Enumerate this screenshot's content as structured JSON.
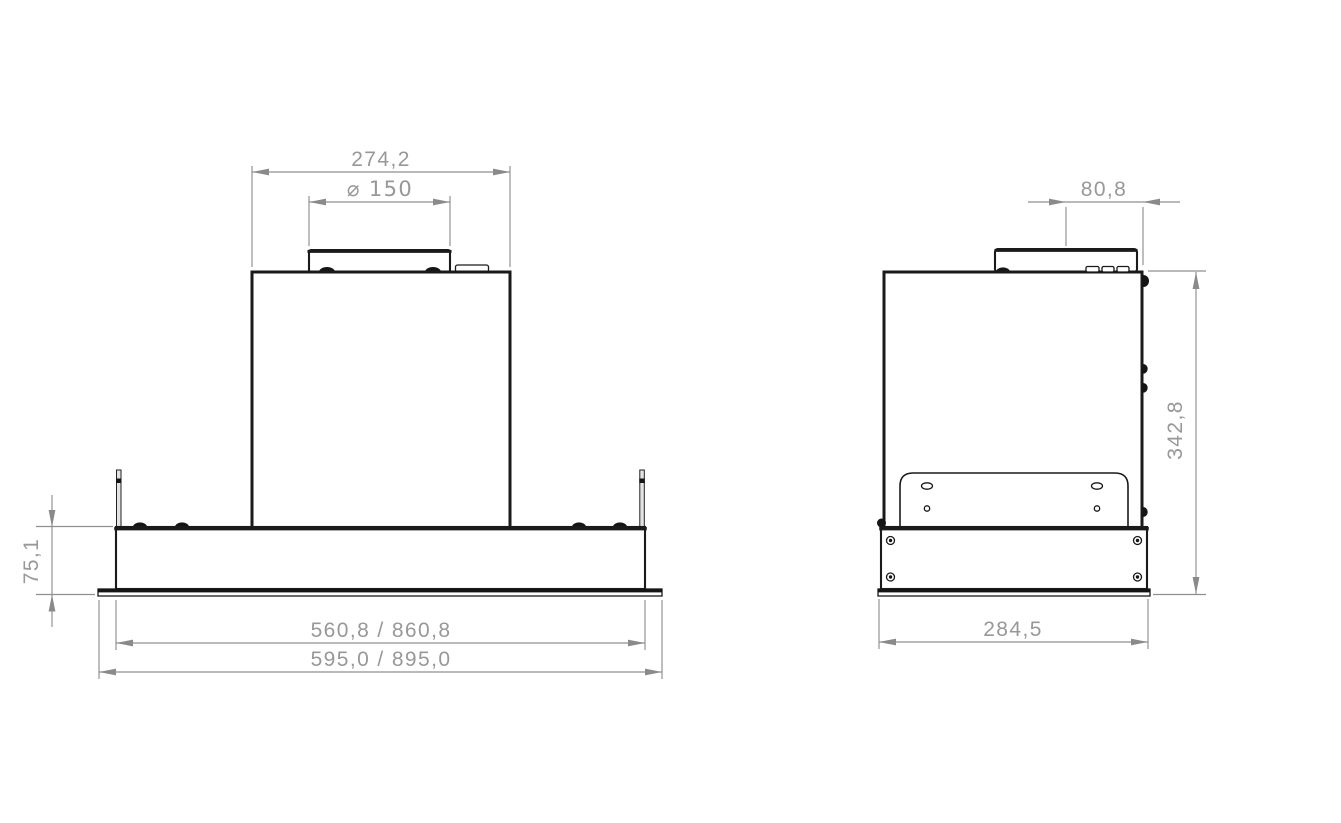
{
  "drawing": {
    "views": {
      "front": {
        "name": "front view"
      },
      "side": {
        "name": "side view"
      }
    },
    "dimensions": {
      "front_body_width": "274,2",
      "front_duct_diameter": "⌀ 150",
      "front_plinth_height": "75,1",
      "front_inner_width": "560,8 / 860,8",
      "front_overall_width": "595,0 / 895,0",
      "side_duct_offset": "80,8",
      "side_overall_height": "342,8",
      "side_overall_depth": "284,5"
    },
    "colors": {
      "background": "#ffffff",
      "outline": "#1a1a1a",
      "dimension_lines": "#8f8f8f",
      "dimension_text": "#989898"
    }
  }
}
